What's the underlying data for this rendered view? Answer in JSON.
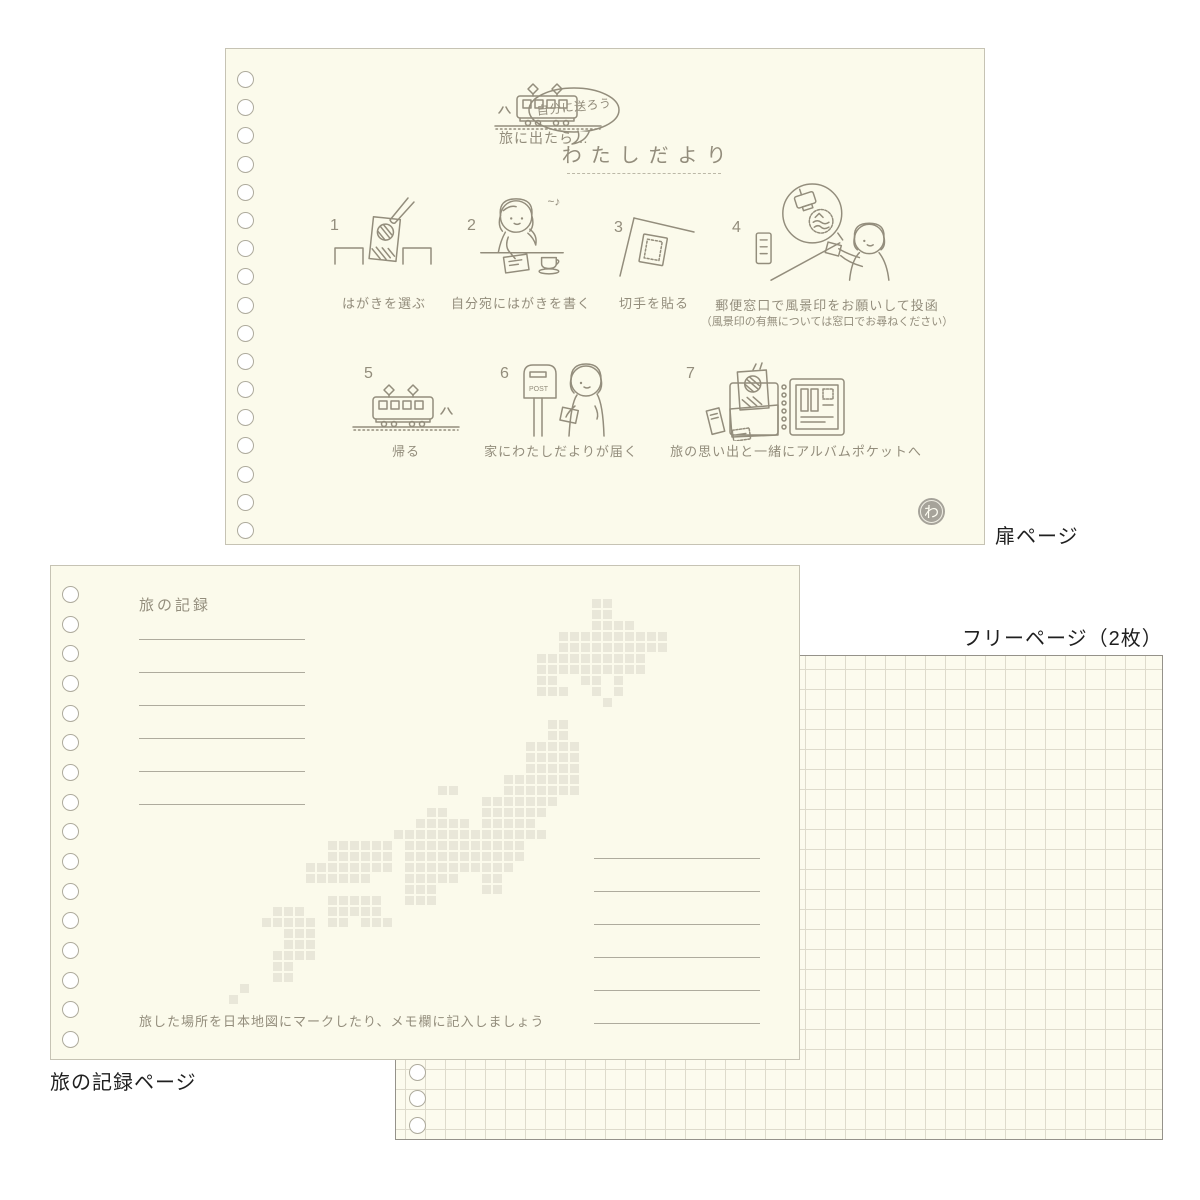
{
  "labels": {
    "title_page": "扉ページ",
    "record_page": "旅の記録ページ",
    "free_page": "フリーページ（2枚）"
  },
  "title_page": {
    "intro_text": "旅に出たら…",
    "bubble_text": "自分に送ろう",
    "title": "わたしだより",
    "logo_char": "わ",
    "steps": [
      {
        "num": "1",
        "caption": "はがきを選ぶ",
        "icon": "postcard-rack-icon"
      },
      {
        "num": "2",
        "caption": "自分宛にはがきを書く",
        "icon": "writing-girl-icon"
      },
      {
        "num": "3",
        "caption": "切手を貼る",
        "icon": "stamp-postcard-icon"
      },
      {
        "num": "4",
        "caption": "郵便窓口で風景印をお願いして投函",
        "subcaption": "（風景印の有無については窓口でお尋ねください）",
        "icon": "post-office-icon"
      },
      {
        "num": "5",
        "caption": "帰る",
        "icon": "return-train-icon"
      },
      {
        "num": "6",
        "caption": "家にわたしだよりが届く",
        "icon": "mailbox-icon"
      },
      {
        "num": "7",
        "caption": "旅の思い出と一緒にアルバムポケットへ",
        "icon": "album-pocket-icon"
      }
    ]
  },
  "record_page": {
    "title": "旅の記録",
    "note": "旅した場所を日本地図にマークしたり、メモ欄に記入しましょう",
    "memo_lines_left": 6,
    "memo_lines_right": 6,
    "japan_map": {
      "description": "pixel-art map of Japan",
      "rows": [
        ".................................##.....",
        ".................................##.....",
        ".................................####...",
        "..............................##########",
        "..............................##########",
        "............................##########..",
        "............................##########..",
        "............................##..##.#....",
        "............................###..#.#....",
        "..................................#.....",
        "........................................",
        ".............................##.........",
        ".............................##.........",
        "...........................#####........",
        "...........................#####........",
        "...........................#####........",
        ".........................#######........",
        "...................##....#######........",
        ".......................#######..........",
        "..................##...######...........",
        ".................#####.#####............",
        "...............##############...........",
        ".........######.###########.............",
        ".........######.###########.............",
        ".......########.##########..............",
        ".......######...#####..##...............",
        "................###....##...............",
        ".........#####..###.....................",
        "....###..#####..........................",
        "...#####.##.###.........................",
        ".....###................................",
        ".....###................................",
        "....####................................",
        "....##..................................",
        "....##..................................",
        ".#......................................",
        "#......................................."
      ]
    }
  },
  "colors": {
    "paper": "#fbfaeb",
    "ink": "#938d7c",
    "pixel": "#e9e7d9",
    "memo_line": "#aeab9d",
    "grid_line": "#dedbcc",
    "label_text": "#1f1f1f"
  }
}
